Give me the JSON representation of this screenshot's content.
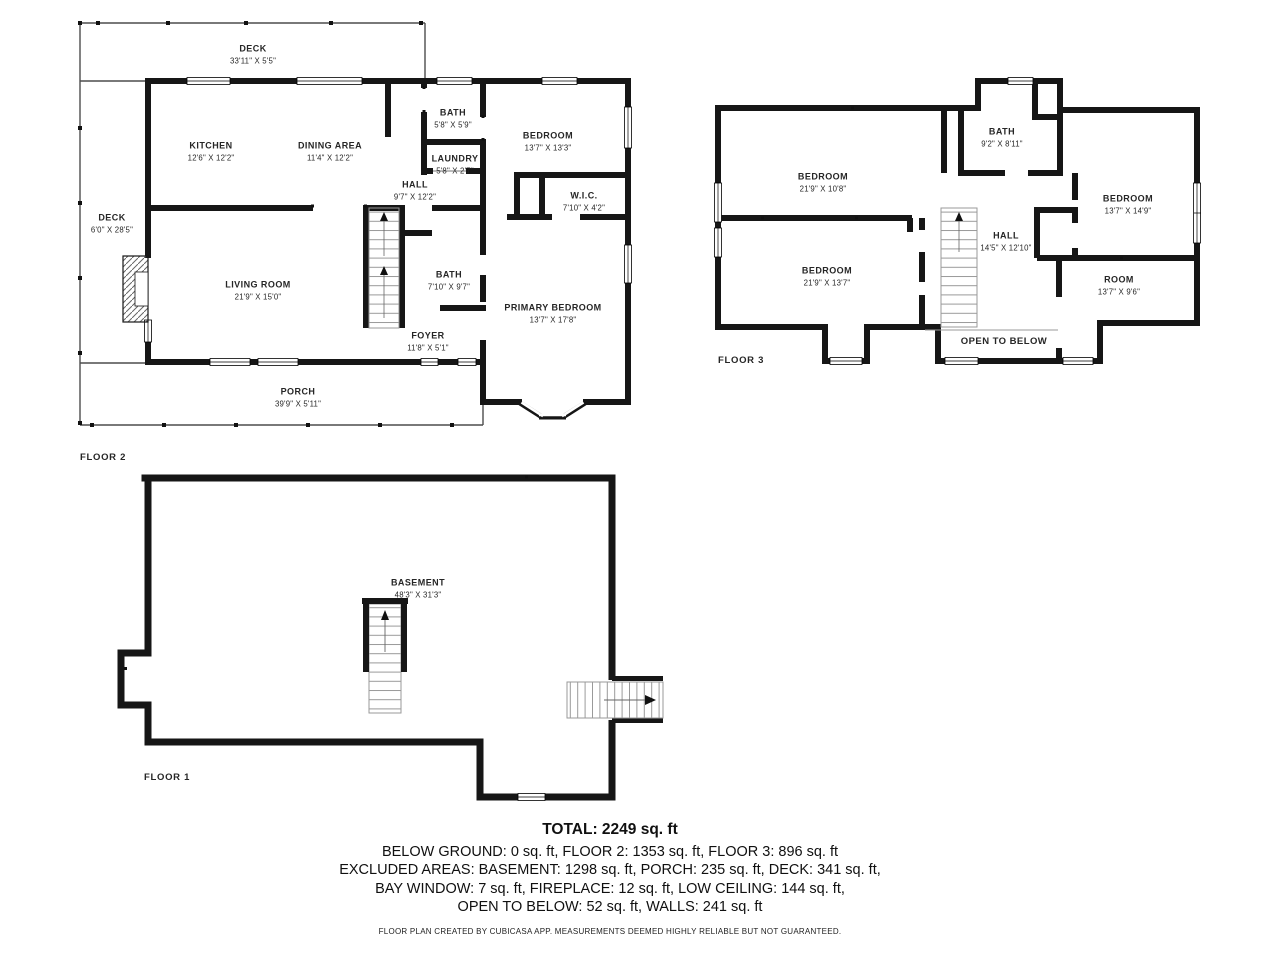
{
  "colors": {
    "wall": "#161616",
    "deck_outline": "#4d4d4d",
    "stair_line": "#999999",
    "text": "#262626"
  },
  "floor2": {
    "floor_label": "FLOOR 2",
    "rooms": [
      {
        "name": "DECK",
        "dims": "33'11\" X 5'5\""
      },
      {
        "name": "KITCHEN",
        "dims": "12'6\" X 12'2\""
      },
      {
        "name": "DINING AREA",
        "dims": "11'4\" X 12'2\""
      },
      {
        "name": "BATH",
        "dims": "5'8\" X 5'9\""
      },
      {
        "name": "LAUNDRY",
        "dims": "5'8\" X 2'7\""
      },
      {
        "name": "HALL",
        "dims": "9'7\" X 12'2\""
      },
      {
        "name": "BEDROOM",
        "dims": "13'7\" X 13'3\""
      },
      {
        "name": "W.I.C.",
        "dims": "7'10\" X 4'2\""
      },
      {
        "name": "DECK",
        "dims": "6'0\" X 28'5\""
      },
      {
        "name": "BATH",
        "dims": "7'10\" X 9'7\""
      },
      {
        "name": "LIVING ROOM",
        "dims": "21'9\" X 15'0\""
      },
      {
        "name": "FOYER",
        "dims": "11'8\" X 5'1\""
      },
      {
        "name": "PRIMARY BEDROOM",
        "dims": "13'7\" X 17'8\""
      },
      {
        "name": "PORCH",
        "dims": "39'9\" X 5'11\""
      }
    ]
  },
  "floor3": {
    "floor_label": "FLOOR 3",
    "rooms": [
      {
        "name": "BEDROOM",
        "dims": "21'9\" X 10'8\""
      },
      {
        "name": "BATH",
        "dims": "9'2\" X 8'11\""
      },
      {
        "name": "BEDROOM",
        "dims": "13'7\" X 14'9\""
      },
      {
        "name": "HALL",
        "dims": "14'5\" X 12'10\""
      },
      {
        "name": "BEDROOM",
        "dims": "21'9\" X 13'7\""
      },
      {
        "name": "ROOM",
        "dims": "13'7\" X 9'6\""
      },
      {
        "name": "OPEN TO BELOW"
      }
    ]
  },
  "floor1": {
    "floor_label": "FLOOR 1",
    "rooms": [
      {
        "name": "BASEMENT",
        "dims": "48'3\" X 31'3\""
      }
    ]
  },
  "summary": {
    "total": "TOTAL: 2249 sq. ft",
    "lines": [
      "BELOW GROUND: 0 sq. ft, FLOOR 2: 1353 sq. ft, FLOOR 3: 896 sq. ft",
      "EXCLUDED AREAS: BASEMENT: 1298 sq. ft, PORCH: 235 sq. ft, DECK: 341 sq. ft,",
      "BAY WINDOW: 7 sq. ft, FIREPLACE: 12 sq. ft, LOW CEILING: 144 sq. ft,",
      "OPEN TO BELOW: 52 sq. ft, WALLS: 241 sq. ft"
    ],
    "disclaimer": "FLOOR PLAN CREATED BY CUBICASA APP. MEASUREMENTS DEEMED HIGHLY RELIABLE BUT NOT GUARANTEED."
  }
}
